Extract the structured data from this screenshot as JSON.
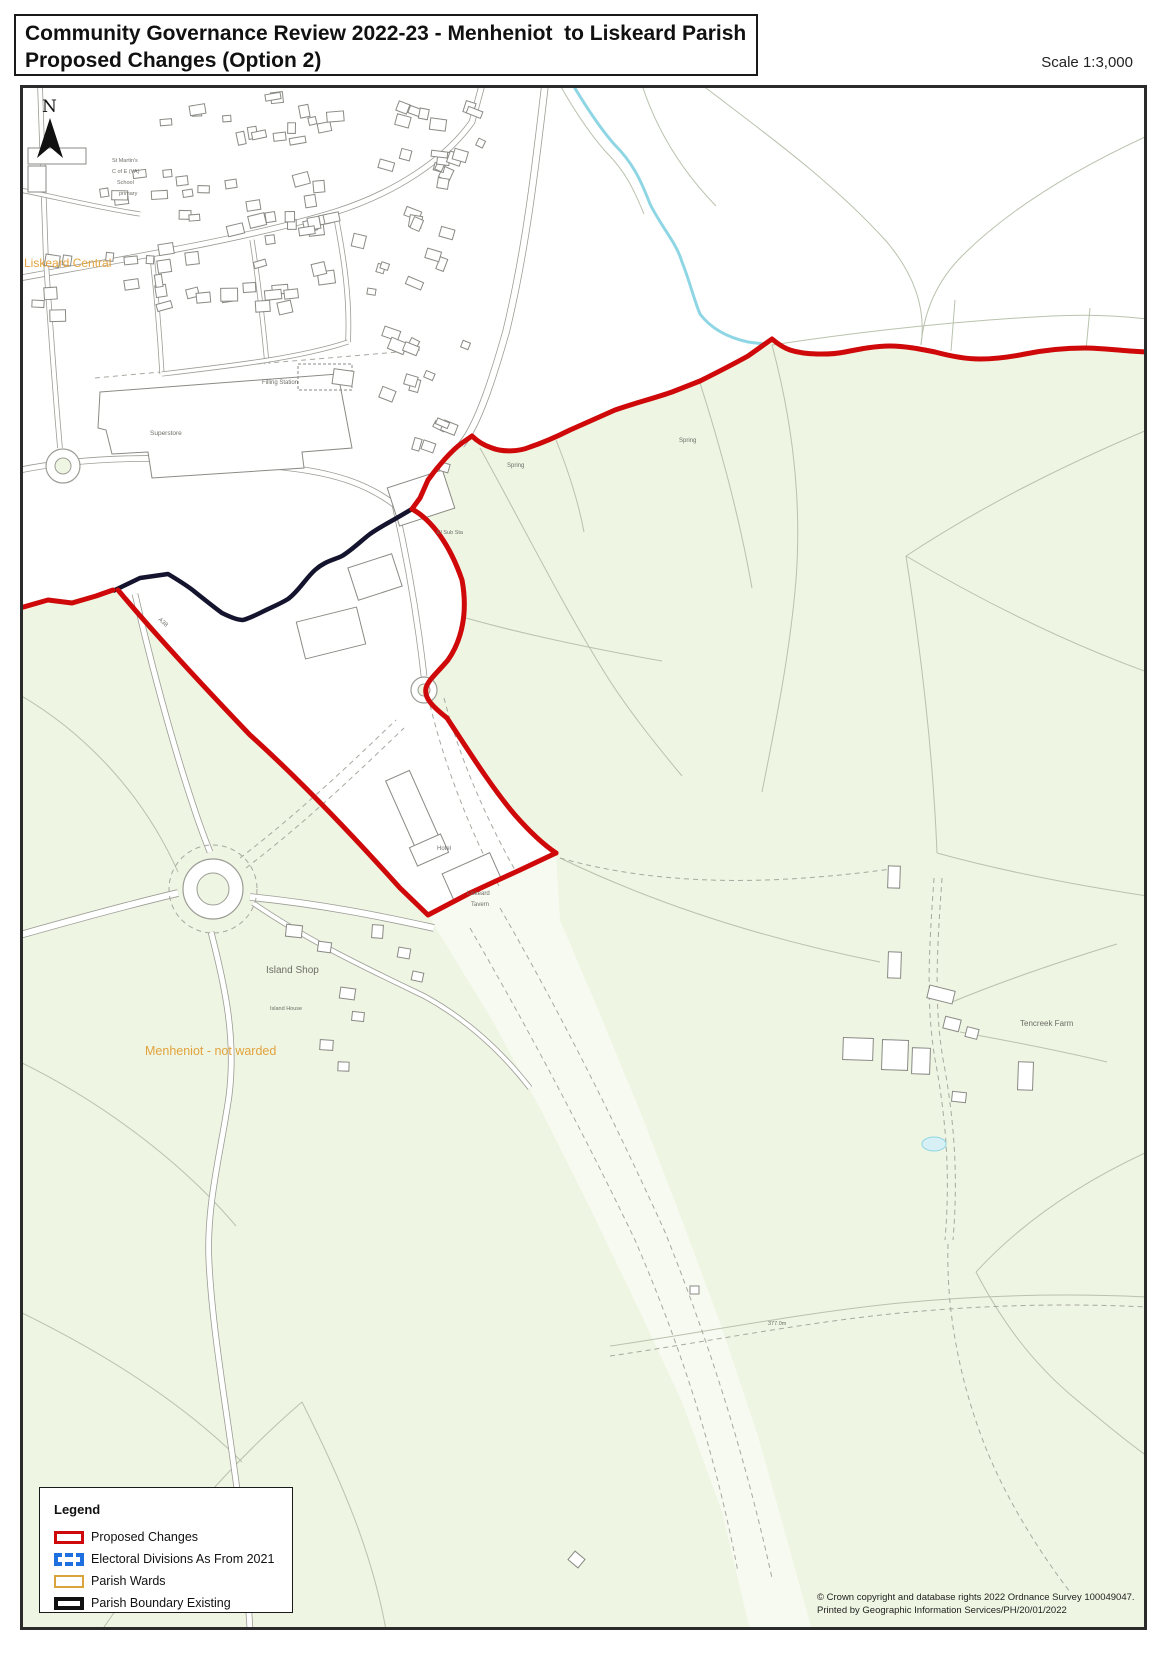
{
  "title": {
    "line1": "Community Governance Review 2022-23 - Menheniot  to Liskeard Parish",
    "line2": "Proposed Changes (Option 2)"
  },
  "scale_label": "Scale 1:3,000",
  "legend": {
    "heading": "Legend",
    "items": [
      {
        "label": "Proposed Changes",
        "swatch": "proposed",
        "color": "#cf0909"
      },
      {
        "label": "Electoral Divisions As From 2021",
        "swatch": "electoral",
        "color": "#1e6fdf"
      },
      {
        "label": "Parish Wards",
        "swatch": "ward",
        "color": "#d9a43c"
      },
      {
        "label": "Parish Boundary Existing",
        "swatch": "parish",
        "color": "#111111"
      }
    ]
  },
  "copyright": {
    "line1": "© Crown copyright and database rights 2022 Ordnance Survey 100049047.",
    "line2": "Printed by Geographic Information Services/PH/20/01/2022"
  },
  "north_label": "N",
  "map": {
    "frame": {
      "x": 20,
      "y": 85,
      "w": 1127,
      "h": 1545
    },
    "colors": {
      "green": "#eef5e2",
      "white": "#ffffff",
      "corridor": "#f7faf0",
      "fieldline": "#b9c2ae",
      "road": "#9c9c96",
      "track": "#a8a8a0",
      "building": "#8a8a85",
      "stream": "#8fd6e4",
      "pond": "#d6f0f6",
      "red": "#cf0909",
      "dark": "#14142e",
      "orange": "#e2a33e",
      "gray": "#6e6e68"
    },
    "white_areas": [
      "20,85 545,85 538,160 526,248 506,330 494,373 478,425 462,443 445,458 428,480 420,498 412,509 395,519 370,534 342,556 315,570 288,599 262,612 243,620 222,613 195,592 168,574 140,578 113,591 70,600 20,608",
      "545,85 1147,85 1147,352 1115,351 1085,348 1055,349 1025,354 995,359 965,358 935,352 905,346 875,346 845,352 815,355 790,350 772,339 766,344 748,356 725,368 700,381 672,392 645,400 615,410 585,423 556,437 530,447 510,452 492,448 480,442 472,436 462,443 478,425 494,373 506,330 526,248 538,160",
      "113,591 140,578 168,574 195,592 222,613 243,620 262,612 288,599 315,570 342,556 370,534 395,519 412,509 432,520 450,545 462,580 466,615 455,650 437,668 425,685 432,702 447,718 468,750 492,788 515,815 537,835 556,853 520,870 470,893 428,915 400,888 355,838 300,780 250,735 205,688 160,640 118,590"
    ],
    "corridor_poly": "428,915 492,1020 542,1112 592,1212 640,1312 682,1402 722,1512 750,1630 812,1630 786,1536 758,1436 722,1328 682,1220 642,1116 600,1014 560,920 556,853 520,870 470,893",
    "field_lines": [
      "M480,448 C520,520 560,600 600,665 C622,702 652,740 682,776",
      "M700,383 C722,452 740,520 752,588",
      "M772,345 C792,420 802,500 796,580 C790,652 776,722 762,792",
      "M556,440 C568,470 578,500 584,532",
      "M466,618 C530,636 600,650 662,661",
      "M1147,430 C1062,466 982,506 906,556",
      "M906,556 C921,652 933,752 937,853",
      "M560,858 C660,906 770,940 880,962",
      "M906,556 C982,601 1062,641 1147,672",
      "M937,853 C1002,871 1082,886 1147,896",
      "M20,695 C82,731 142,791 178,872",
      "M20,1062 C102,1102 182,1162 236,1226",
      "M20,1312 C102,1352 182,1402 242,1462",
      "M102,1630 C162,1542 232,1462 302,1402",
      "M302,1402 C342,1482 372,1552 386,1630",
      "M1147,1152 C1082,1182 1022,1222 976,1272",
      "M976,1272 C1002,1322 1032,1362 1072,1396",
      "M1072,1396 C1102,1421 1126,1441 1147,1456",
      "M702,85 C762,131 832,181 886,241 C916,276 926,311 921,345",
      "M642,85 C657,131 682,171 716,206",
      "M1147,136 C1082,166 1012,206 962,256 C937,281 924,311 921,345",
      "M955,300 L951,351",
      "M1090,308 L1086,350",
      "M772,345 C852,333 952,321 1052,316 C1092,314 1122,316 1147,319",
      "M960,1032 C1015,1042 1065,1052 1107,1062",
      "M952,1002 C1010,978 1065,960 1117,944",
      "M610,1346 C700,1333 800,1313 900,1303 C985,1295 1065,1293 1147,1297"
    ],
    "tracks": [
      "M560,858 C660,886 770,886 898,868",
      "M240,858 C300,812 350,764 396,720",
      "M246,868 C306,822 356,774 404,728",
      "M430,705 C446,770 470,830 500,888",
      "M444,698 C460,760 486,818 516,872",
      "M470,928 C530,1032 585,1136 635,1240 C678,1340 714,1446 738,1572",
      "M500,908 C560,1012 615,1122 665,1232 C705,1332 743,1446 772,1578",
      "M934,878 C929,950 925,1010 937,1070 C947,1128 950,1180 945,1240",
      "M942,878 C937,950 933,1010 945,1070 C955,1128 958,1180 953,1240",
      "M948,1244 C946,1312 960,1382 985,1446 C1005,1496 1035,1546 1070,1592",
      "M610,1356 C700,1343 800,1323 900,1313 C985,1305 1065,1303 1147,1307",
      "M95,378 C200,368 310,360 420,350"
    ],
    "roads": [
      {
        "d": "M20,278 C130,258 250,238 335,212 C395,193 445,160 472,122 L482,85",
        "w": 5
      },
      {
        "d": "M20,470 C110,452 210,458 290,468 C340,474 370,486 395,505",
        "w": 5
      },
      {
        "d": "M60,448 C54,380 50,320 46,262",
        "w": 4
      },
      {
        "d": "M46,262 C44,205 42,145 40,85",
        "w": 4
      },
      {
        "d": "M335,212 C345,262 350,302 348,342",
        "w": 4
      },
      {
        "d": "M152,256 C157,300 160,340 162,374",
        "w": 3.5
      },
      {
        "d": "M252,240 C260,292 264,332 267,364",
        "w": 3.5
      },
      {
        "d": "M162,374 C230,366 300,358 348,342",
        "w": 3.5
      },
      {
        "d": "M20,190 C60,198 100,208 140,214",
        "w": 3.5
      },
      {
        "d": "M395,505 C408,562 418,622 424,676",
        "w": 5
      },
      {
        "d": "M545,85 C536,162 526,250 506,332 C494,374 478,426 461,445",
        "w": 6
      },
      {
        "d": "M20,935 C80,918 140,902 178,893",
        "w": 6
      },
      {
        "d": "M211,932 C226,990 236,1040 229,1096 C221,1152 206,1205 209,1262 C213,1342 231,1432 241,1522 C246,1578 249,1608 250,1630",
        "w": 5
      },
      {
        "d": "M135,594 C150,660 172,742 192,802 C200,827 206,842 210,852",
        "w": 5
      },
      {
        "d": "M250,897 C320,904 380,916 434,928",
        "w": 6
      },
      {
        "d": "M253,903 C310,942 370,970 424,996 C468,1020 502,1052 530,1088",
        "w": 4
      }
    ],
    "stream": "M573,85 C585,105 600,128 614,144 C632,162 640,178 650,204 C662,228 676,242 682,262 C690,282 694,300 700,314 C712,330 730,338 748,342 L764,344",
    "stream_side": "M560,85 C574,110 590,134 606,152 C626,172 634,190 644,214",
    "pond": {
      "cx": 934,
      "cy": 1144,
      "rx": 12,
      "ry": 7
    },
    "roundabouts": [
      {
        "cx": 213,
        "cy": 889,
        "ro": 30,
        "ri": 16,
        "dashed": 44
      },
      {
        "cx": 424,
        "cy": 690,
        "ro": 13,
        "ri": 6,
        "dashed": 0
      },
      {
        "cx": 63,
        "cy": 466,
        "ro": 17,
        "ri": 8,
        "dashed": 0
      }
    ],
    "superstore_path": "M100,392 L338,374 L352,448 L302,452 L304,468 L152,478 L148,452 L112,454 L106,430 L98,428 Z",
    "filling_canopy": {
      "x": 298,
      "y": 364,
      "w": 54,
      "h": 26
    },
    "buildings": [
      {
        "x": 392,
        "y": 478,
        "w": 58,
        "h": 40,
        "a": -18
      },
      {
        "x": 352,
        "y": 560,
        "w": 46,
        "h": 34,
        "a": -18
      },
      {
        "x": 300,
        "y": 614,
        "w": 62,
        "h": 38,
        "a": -14
      },
      {
        "x": 402,
        "y": 772,
        "w": 26,
        "h": 86,
        "a": -24
      },
      {
        "x": 412,
        "y": 840,
        "w": 34,
        "h": 20,
        "a": -24
      },
      {
        "x": 446,
        "y": 862,
        "w": 52,
        "h": 30,
        "a": -24
      },
      {
        "x": 333,
        "y": 370,
        "w": 20,
        "h": 15,
        "a": 8
      },
      {
        "x": 28,
        "y": 148,
        "w": 58,
        "h": 16,
        "a": 0
      },
      {
        "x": 28,
        "y": 166,
        "w": 18,
        "h": 26,
        "a": 0
      },
      {
        "x": 286,
        "y": 925,
        "w": 16,
        "h": 12,
        "a": 6
      },
      {
        "x": 318,
        "y": 942,
        "w": 13,
        "h": 10,
        "a": 8
      },
      {
        "x": 372,
        "y": 925,
        "w": 11,
        "h": 13,
        "a": 4
      },
      {
        "x": 398,
        "y": 948,
        "w": 12,
        "h": 10,
        "a": 10
      },
      {
        "x": 412,
        "y": 972,
        "w": 11,
        "h": 9,
        "a": 12
      },
      {
        "x": 340,
        "y": 988,
        "w": 15,
        "h": 11,
        "a": 8
      },
      {
        "x": 352,
        "y": 1012,
        "w": 12,
        "h": 9,
        "a": 6
      },
      {
        "x": 320,
        "y": 1040,
        "w": 13,
        "h": 10,
        "a": 4
      },
      {
        "x": 338,
        "y": 1062,
        "w": 11,
        "h": 9,
        "a": 2
      },
      {
        "x": 888,
        "y": 952,
        "w": 13,
        "h": 26,
        "a": 2
      },
      {
        "x": 928,
        "y": 988,
        "w": 26,
        "h": 13,
        "a": 14
      },
      {
        "x": 944,
        "y": 1018,
        "w": 16,
        "h": 12,
        "a": 14
      },
      {
        "x": 966,
        "y": 1028,
        "w": 12,
        "h": 10,
        "a": 14
      },
      {
        "x": 843,
        "y": 1038,
        "w": 30,
        "h": 22,
        "a": 2
      },
      {
        "x": 882,
        "y": 1040,
        "w": 26,
        "h": 30,
        "a": 2
      },
      {
        "x": 912,
        "y": 1048,
        "w": 18,
        "h": 26,
        "a": 2
      },
      {
        "x": 1018,
        "y": 1062,
        "w": 15,
        "h": 28,
        "a": 2
      },
      {
        "x": 952,
        "y": 1092,
        "w": 14,
        "h": 10,
        "a": 6
      },
      {
        "x": 888,
        "y": 866,
        "w": 12,
        "h": 22,
        "a": 2
      },
      {
        "x": 690,
        "y": 1286,
        "w": 9,
        "h": 8,
        "a": 0
      },
      {
        "x": 570,
        "y": 1554,
        "w": 13,
        "h": 11,
        "a": 40
      }
    ],
    "building_clusters": [
      [
        150,
        92,
        210,
        55,
        16,
        -6
      ],
      [
        365,
        95,
        120,
        85,
        12,
        18
      ],
      [
        95,
        150,
        130,
        75,
        9,
        -4
      ],
      [
        175,
        170,
        175,
        75,
        13,
        -8
      ],
      [
        350,
        200,
        125,
        100,
        11,
        16
      ],
      [
        235,
        255,
        125,
        65,
        9,
        -10
      ],
      [
        85,
        235,
        95,
        85,
        7,
        -2
      ],
      [
        28,
        240,
        60,
        85,
        5,
        4
      ],
      [
        355,
        325,
        115,
        85,
        9,
        22
      ],
      [
        385,
        420,
        85,
        55,
        6,
        20
      ],
      [
        150,
        250,
        90,
        60,
        7,
        -8
      ],
      [
        255,
        180,
        90,
        60,
        7,
        -8
      ],
      [
        430,
        115,
        55,
        75,
        6,
        14
      ]
    ],
    "red_paths": [
      "M20,608 L48,600 L72,603 L96,596 L113,590",
      "M118,590 C160,640 205,688 250,735 C300,780 355,838 400,888 L428,915 L470,893 L520,870 L556,853",
      "M412,509 C432,520 450,545 462,580 C468,612 462,640 448,660 C438,672 428,680 426,688 C424,698 432,706 447,718 C468,750 492,788 515,815 C530,832 544,845 556,853",
      "M412,509 L420,498 L428,480 C438,466 452,450 462,443 L472,436 C478,442 486,446 492,448 C502,452 518,452 530,447 C545,442 556,437 570,430 L615,410 C635,403 655,398 672,392 L700,381 C712,375 730,366 748,356 L772,339 C778,344 784,348 790,350 C805,355 830,355 845,352 C860,349 875,346 890,346 C905,346 920,349 935,352 C950,356 965,359 980,359 C995,359 1010,357 1025,354 C1045,350 1065,348 1085,348 C1100,348 1115,350 1130,351 L1147,352"
    ],
    "dark_path": "M113,591 L140,578 L168,574 C178,580 188,586 195,592 C205,600 215,608 222,613 C230,617 238,620 243,620 C250,618 256,615 262,612 C272,607 280,604 288,599 C298,592 306,578 315,570 C325,561 334,560 342,556 C352,550 362,540 370,534 C380,527 388,523 395,519 L412,509",
    "labels": [
      {
        "t": "Liskeard Central",
        "x": 24,
        "y": 267,
        "s": 12,
        "c": "orange"
      },
      {
        "t": "Menheniot - not warded",
        "x": 145,
        "y": 1055,
        "s": 12.5,
        "c": "orange"
      },
      {
        "t": "Island Shop",
        "x": 266,
        "y": 973,
        "s": 10,
        "c": "gray"
      },
      {
        "t": "Tencreek Farm",
        "x": 1020,
        "y": 1026,
        "s": 8,
        "c": "gray"
      },
      {
        "t": "Superstore",
        "x": 150,
        "y": 435,
        "s": 6.5,
        "c": "gray"
      },
      {
        "t": "Filling Station",
        "x": 262,
        "y": 384,
        "s": 6,
        "c": "gray"
      },
      {
        "t": "Hotel",
        "x": 437,
        "y": 850,
        "s": 6,
        "c": "gray"
      },
      {
        "t": "Liskeard",
        "x": 467,
        "y": 895,
        "s": 6,
        "c": "gray"
      },
      {
        "t": "Tavern",
        "x": 471,
        "y": 906,
        "s": 6,
        "c": "gray"
      },
      {
        "t": "Spring",
        "x": 507,
        "y": 467,
        "s": 6,
        "c": "gray"
      },
      {
        "t": "Spring",
        "x": 679,
        "y": 442,
        "s": 6,
        "c": "gray"
      },
      {
        "t": "Island House",
        "x": 270,
        "y": 1010,
        "s": 5.5,
        "c": "gray"
      },
      {
        "t": "El Sub Sta",
        "x": 437,
        "y": 534,
        "s": 5.5,
        "c": "gray"
      },
      {
        "t": "St Martin's",
        "x": 112,
        "y": 162,
        "s": 5.5,
        "c": "gray"
      },
      {
        "t": "C of E (VA)",
        "x": 112,
        "y": 173,
        "s": 5.5,
        "c": "gray"
      },
      {
        "t": "School",
        "x": 117,
        "y": 184,
        "s": 5.5,
        "c": "gray"
      },
      {
        "t": "primary",
        "x": 119,
        "y": 195,
        "s": 5.5,
        "c": "gray"
      },
      {
        "t": "377.0m",
        "x": 768,
        "y": 1325,
        "s": 5.5,
        "c": "gray"
      },
      {
        "t": "A38",
        "x": 158,
        "y": 620,
        "s": 6,
        "c": "gray",
        "r": 42
      }
    ],
    "north": {
      "label_x": 42,
      "label_y": 112,
      "arrow": "50,118 63,158 50,147 37,158"
    }
  }
}
